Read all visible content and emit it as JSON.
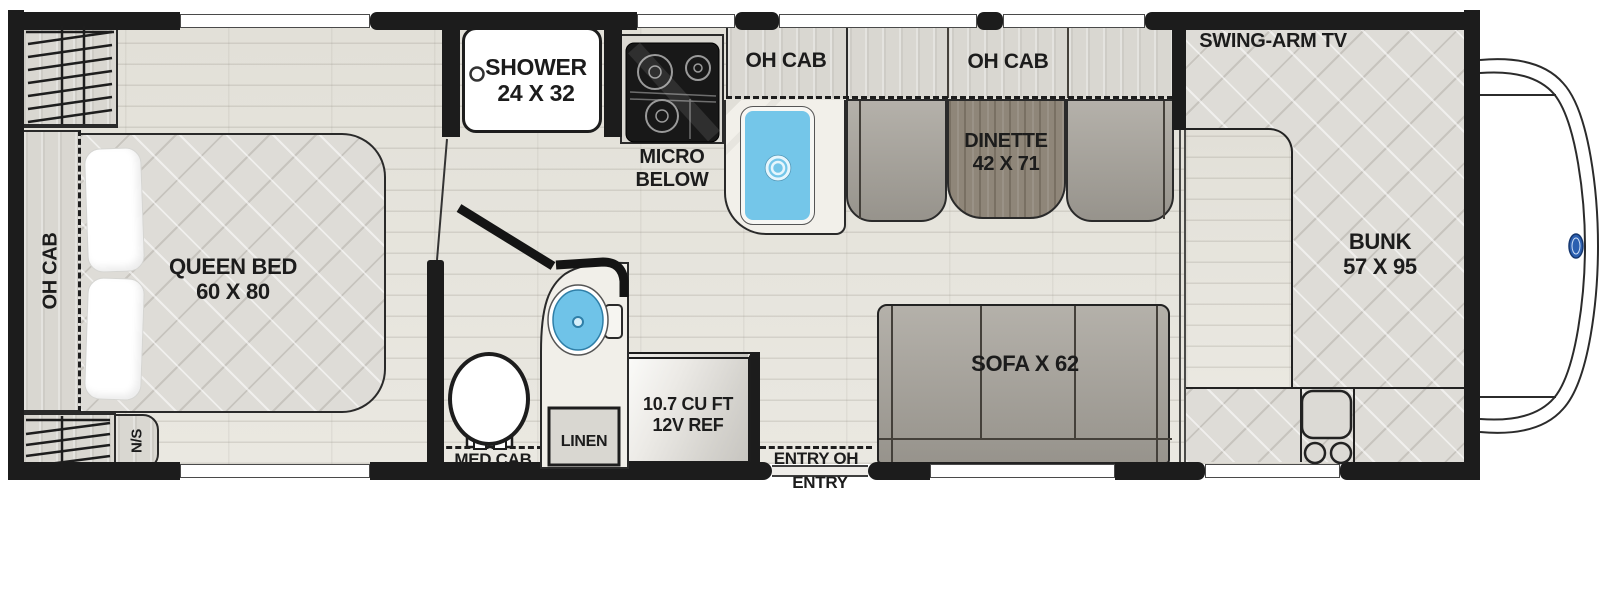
{
  "title": "Class C motorhome floor plan",
  "labels": {
    "shower1": "SHOWER",
    "shower2": "24 X 32",
    "micro1": "MICRO",
    "micro2": "BELOW",
    "oh_cab_kitchen": "OH CAB",
    "oh_cab_dinette": "OH CAB",
    "oh_cab_bedroom": "OH CAB",
    "dinette1": "DINETTE",
    "dinette2": "42 X 71",
    "swing_arm_tv": "SWING-ARM TV",
    "bunk1": "BUNK",
    "bunk2": "57 X 95",
    "queen1": "QUEEN BED",
    "queen2": "60 X 80",
    "nightstand": "N/S",
    "med_cab": "MED CAB",
    "linen": "LINEN",
    "fridge1": "10.7 CU FT",
    "fridge2": "12V REF",
    "entry_oh": "ENTRY OH",
    "entry": "ENTRY",
    "sofa": "SOFA X 62"
  },
  "colors": {
    "wall": "#1c1c1c",
    "floor": "#e7e5de",
    "mattress": "#dedcd7",
    "cushion": "#a8a49c",
    "table_wood": "#8f8679",
    "cabinet": "#d9d7d1",
    "counter_marble": "#f2f0ea",
    "sink_blue": "#74c6e9",
    "ford_badge_blue": "#2b5fb0"
  }
}
